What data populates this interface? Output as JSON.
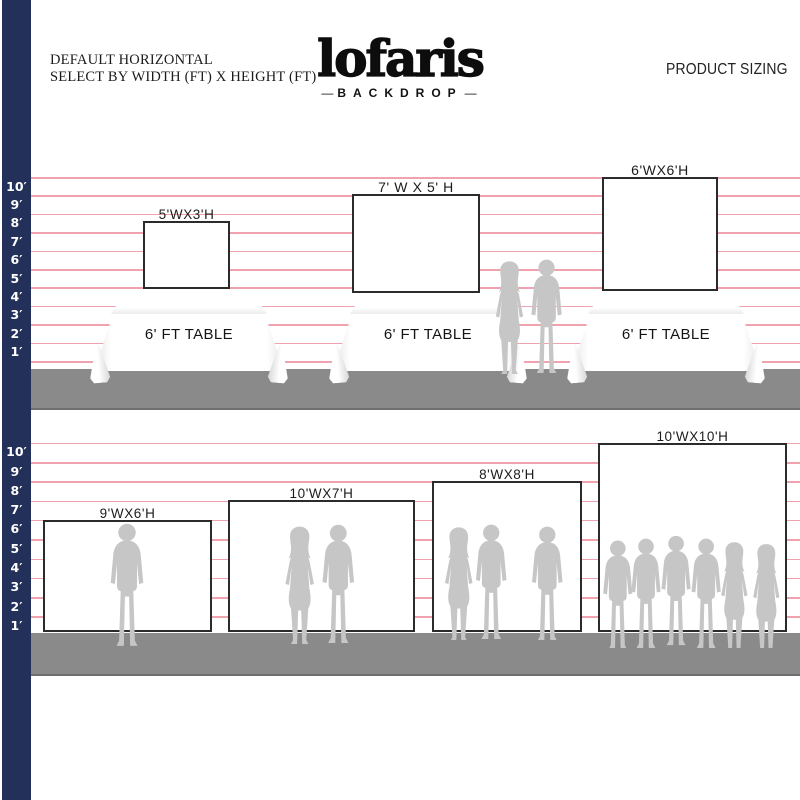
{
  "header": {
    "title_line1": "DEFAULT HORIZONTAL",
    "title_line2": "SELECT BY WIDTH (FT) X HEIGHT (FT)",
    "brand": {
      "name": "lofaris",
      "sub": "BACKDROP",
      "dash": "—"
    },
    "page_label": "PRODUCT SIZING"
  },
  "ruler": {
    "labels": [
      "10′",
      "9′",
      "8′",
      "7′",
      "6′",
      "5′",
      "4′",
      "3′",
      "2′",
      "1′"
    ]
  },
  "top_row": {
    "table_label": "6' FT TABLE",
    "backdrops": [
      {
        "size": "5'WX3'H"
      },
      {
        "size": "7' W X 5' H"
      },
      {
        "size": "6'WX6'H"
      }
    ]
  },
  "bottom_row": {
    "backdrops": [
      {
        "size": "9'WX6'H",
        "people": 1
      },
      {
        "size": "10'WX7'H",
        "people": 2
      },
      {
        "size": "8'WX8'H",
        "people": 3
      },
      {
        "size": "10'WX10'H",
        "people": 6
      }
    ]
  },
  "colors": {
    "rail_navy": "#22305a",
    "line_pink": "#f0a3ae",
    "floor_gray": "#8a8a8a",
    "silhouette_gray": "#c6c6c6",
    "backdrop_border": "#2b2b2b"
  }
}
